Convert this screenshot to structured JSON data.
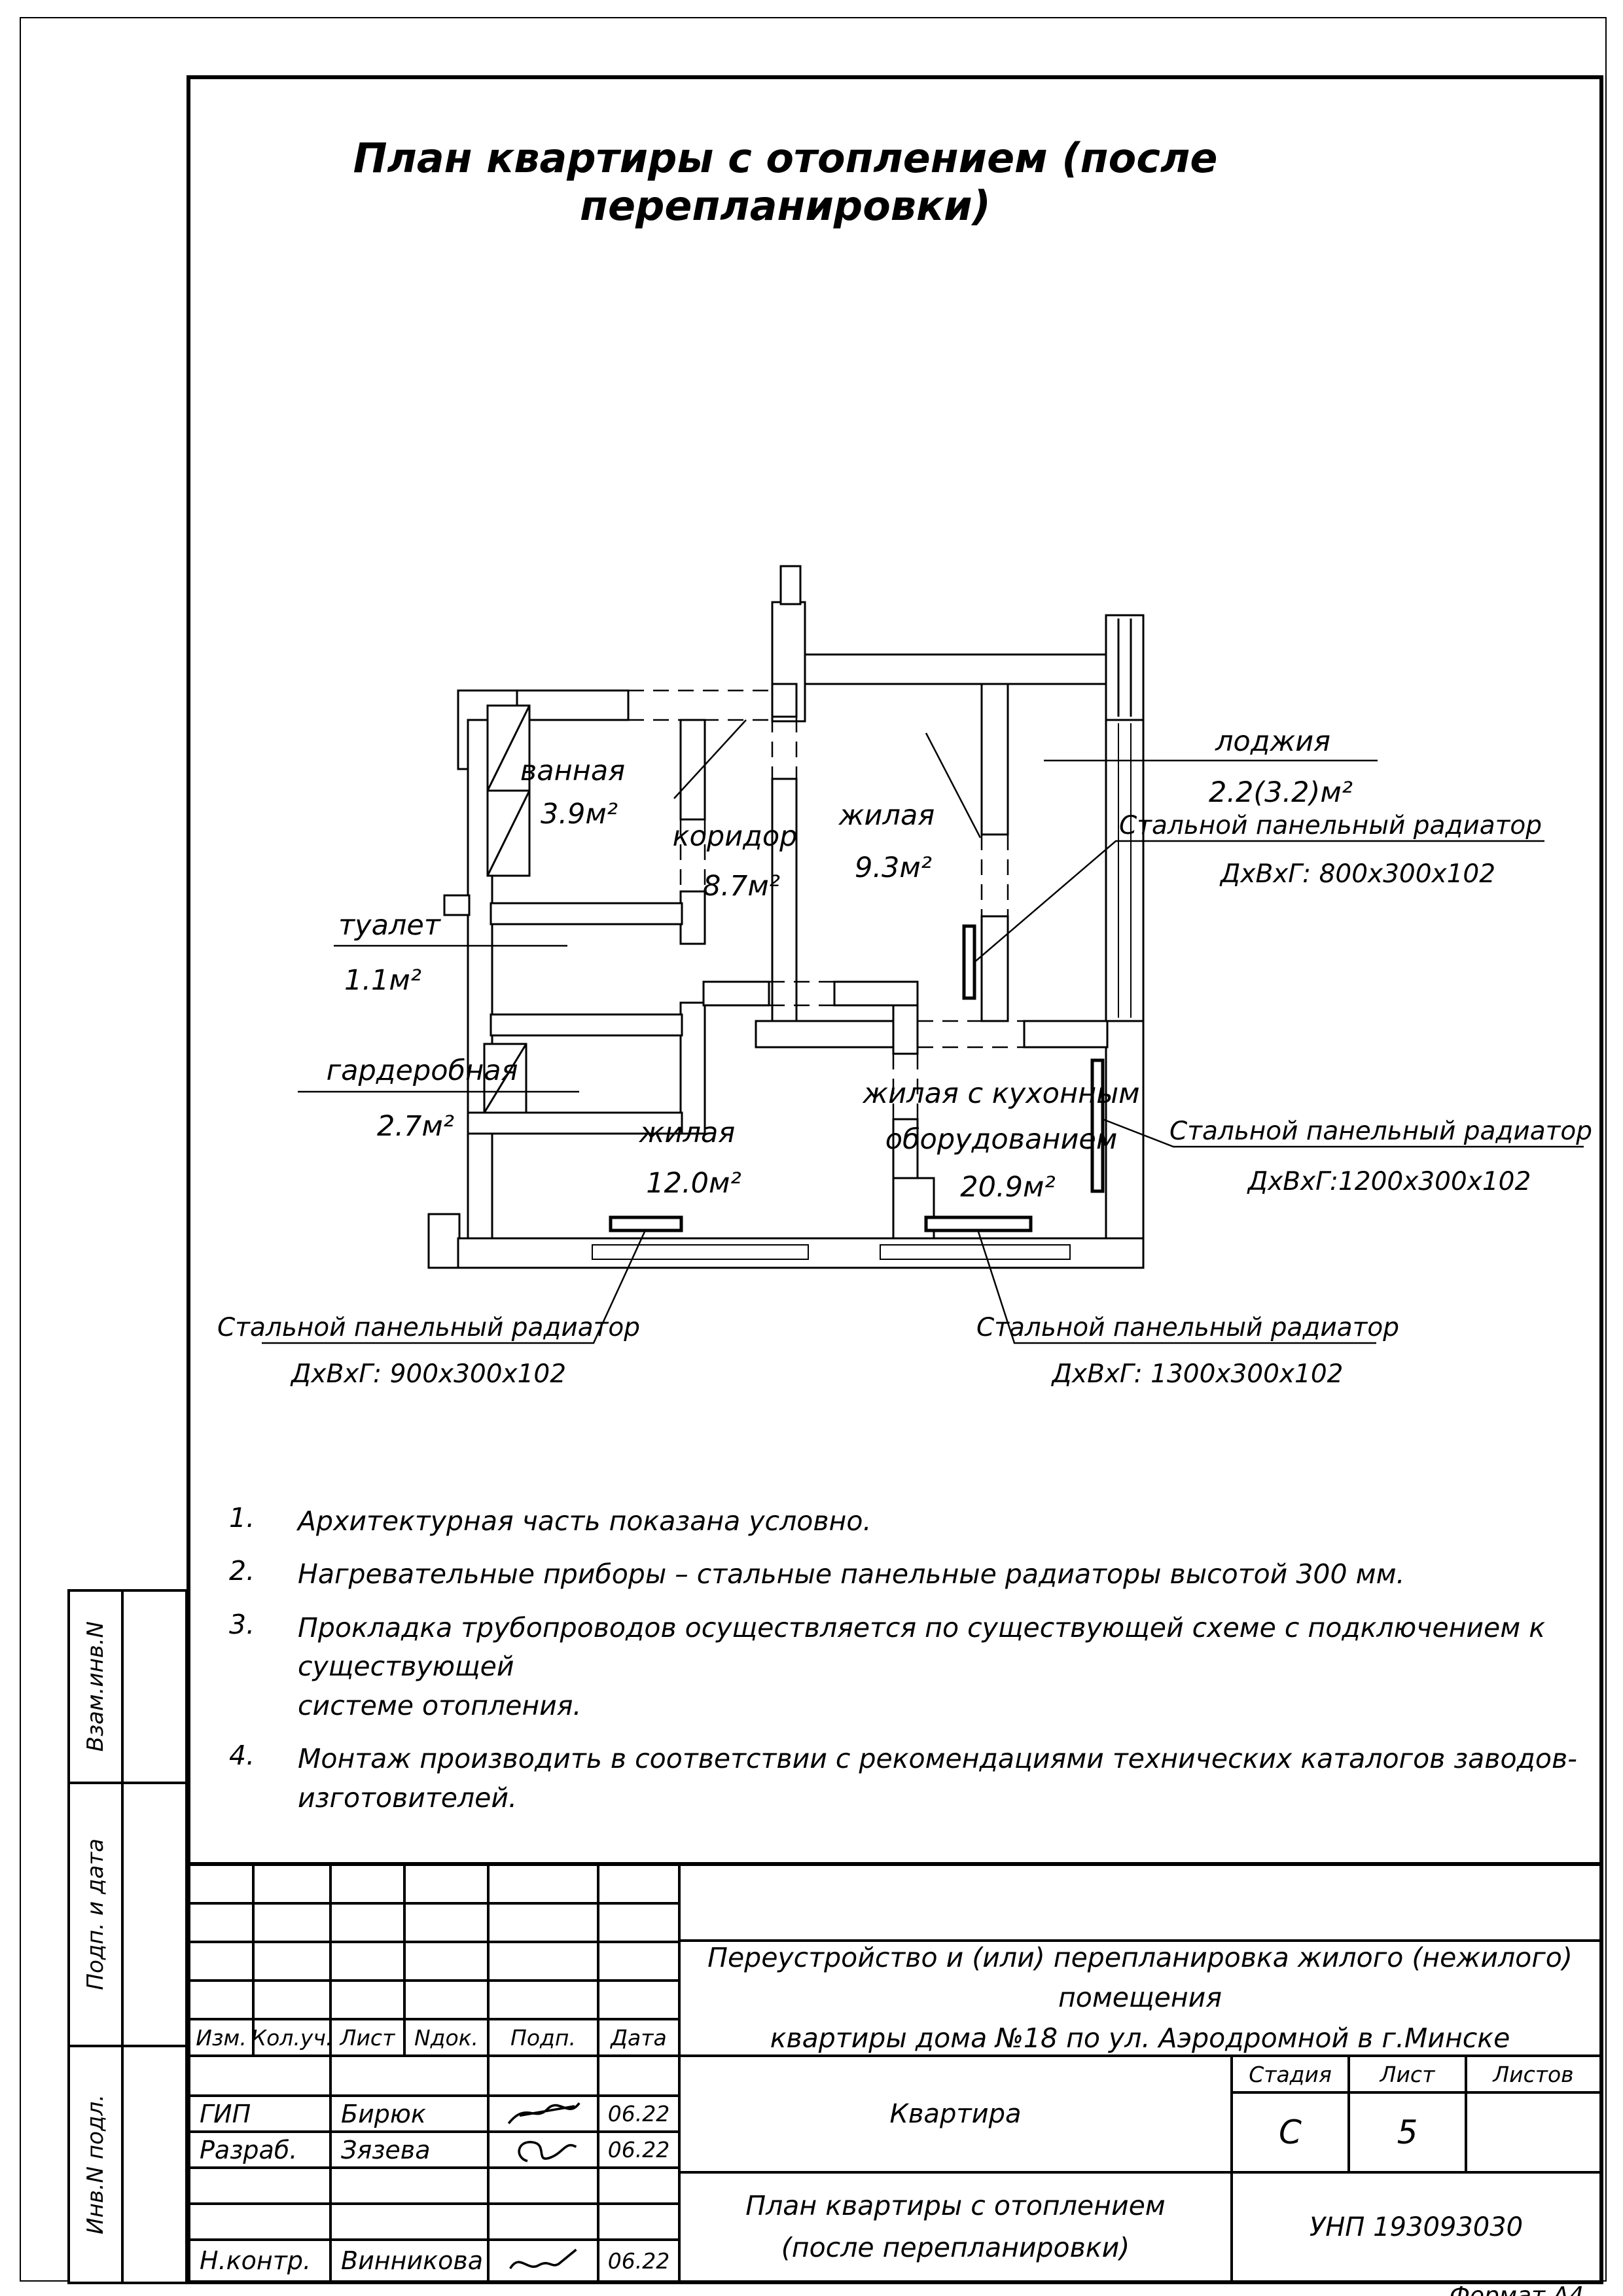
{
  "page": {
    "title": "План квартиры с отоплением (после перепланировки)",
    "format_label": "Формат А4"
  },
  "plan": {
    "rooms": {
      "vannaya": {
        "name": "ванная",
        "area": "3.9м²"
      },
      "koridor": {
        "name": "коридор",
        "area": "8.7м²"
      },
      "zhilaya93": {
        "name": "жилая",
        "area": "9.3м²"
      },
      "lodzhiya": {
        "name": "лоджия",
        "area": "2.2(3.2)м²"
      },
      "tualet": {
        "name": "туалет",
        "area": "1.1м²"
      },
      "garderob": {
        "name": "гардеробная",
        "area": "2.7м²"
      },
      "zhilaya12": {
        "name": "жилая",
        "area": "12.0м²"
      },
      "zhilaya209": {
        "name1": "жилая с кухонным",
        "name2": "оборудованием",
        "area": "20.9м²"
      }
    },
    "radiators": {
      "rad800": {
        "label": "Стальной панельный радиатор",
        "dims": "ДхВхГ: 800х300х102"
      },
      "rad1200": {
        "label": "Стальной панельный радиатор",
        "dims": "ДхВхГ:1200х300х102"
      },
      "rad900": {
        "label": "Стальной панельный радиатор",
        "dims": "ДхВхГ: 900х300х102"
      },
      "rad1300": {
        "label": "Стальной панельный радиатор",
        "dims": "ДхВхГ: 1300х300х102"
      }
    }
  },
  "notes": [
    {
      "num": "1.",
      "text": "Архитектурная часть показана условно.",
      "text2": ""
    },
    {
      "num": "2.",
      "text": "Нагревательные приборы – стальные панельные радиаторы высотой 300 мм.",
      "text2": ""
    },
    {
      "num": "3.",
      "text": "Прокладка трубопроводов осуществляется по существующей схеме с подключением к существующей",
      "text2": "системе отопления."
    },
    {
      "num": "4.",
      "text": "Монтаж производить в соответствии с рекомендациями технических каталогов заводов-изготовителей.",
      "text2": ""
    }
  ],
  "sidebar": {
    "label1": "Взам.инв.N",
    "label2": "Подп. и дата",
    "label3": "Инв.N подл."
  },
  "titleblock": {
    "cols": {
      "c1": "Изм.",
      "c2": "Кол.уч.",
      "c3": "Лист",
      "c4": "Nдок.",
      "c5": "Подп.",
      "c6": "Дата"
    },
    "rows": {
      "gip": {
        "role": "ГИП",
        "name": "Бирюк",
        "date": "06.22"
      },
      "razrab": {
        "role": "Разраб.",
        "name": "Зязева",
        "date": "06.22"
      },
      "nkontr": {
        "role": "Н.контр.",
        "name": "Винникова",
        "date": "06.22"
      }
    },
    "project_line1": "Переустройство и (или) перепланировка жилого (нежилого) помещения",
    "project_line2": "квартиры дома №18 по ул. Аэродромной в г.Минске",
    "object": "Квартира",
    "stage_label": "Стадия",
    "sheet_label": "Лист",
    "sheets_label": "Листов",
    "stage": "С",
    "sheet": "5",
    "sheets": "",
    "doc_title_line1": "План квартиры с отоплением",
    "doc_title_line2": "(после перепланировки)",
    "unp": "УНП 193093030"
  }
}
